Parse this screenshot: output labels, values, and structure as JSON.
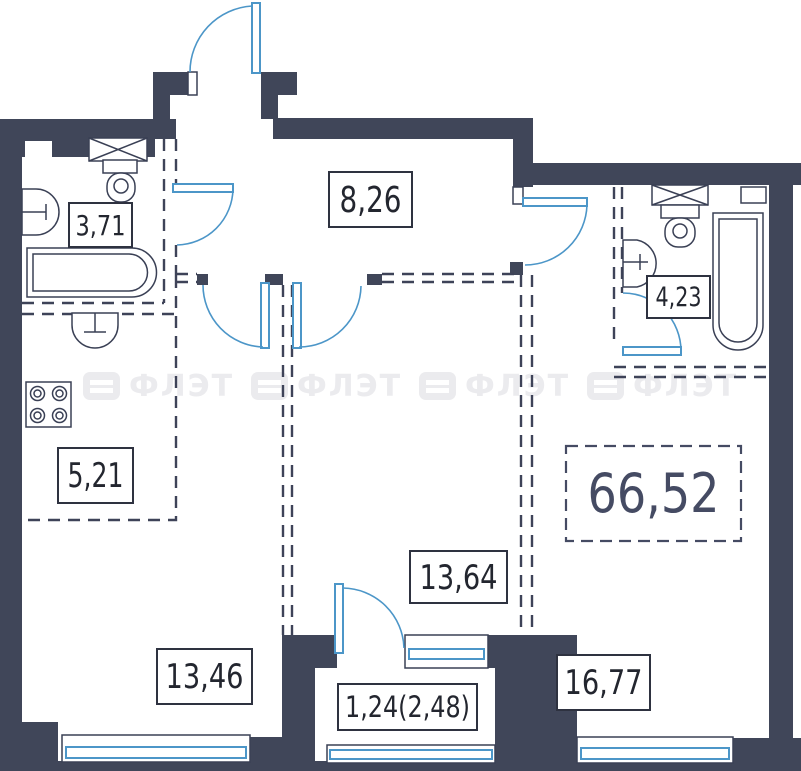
{
  "plan": {
    "title": "apartment-floor-plan",
    "total_area": "66,52",
    "rooms": [
      {
        "name": "bathroom-top-left",
        "area": "3,71"
      },
      {
        "name": "hallway",
        "area": "8,26"
      },
      {
        "name": "bathroom-top-right",
        "area": "4,23"
      },
      {
        "name": "kitchen",
        "area": "5,21"
      },
      {
        "name": "room-middle",
        "area": "13,64"
      },
      {
        "name": "room-bottom-left",
        "area": "13,46"
      },
      {
        "name": "room-bottom-right",
        "area": "16,77"
      },
      {
        "name": "balcony",
        "area": "1,24(2,48)"
      }
    ],
    "watermark": {
      "text": "ФЛЭТ"
    },
    "colors": {
      "wall": "#404659",
      "line": "#3A4055",
      "door_window_blue": "#4C96C8",
      "label_text": "#23262F",
      "total_text": "#454B63",
      "watermark": "#EBEBEE"
    }
  }
}
